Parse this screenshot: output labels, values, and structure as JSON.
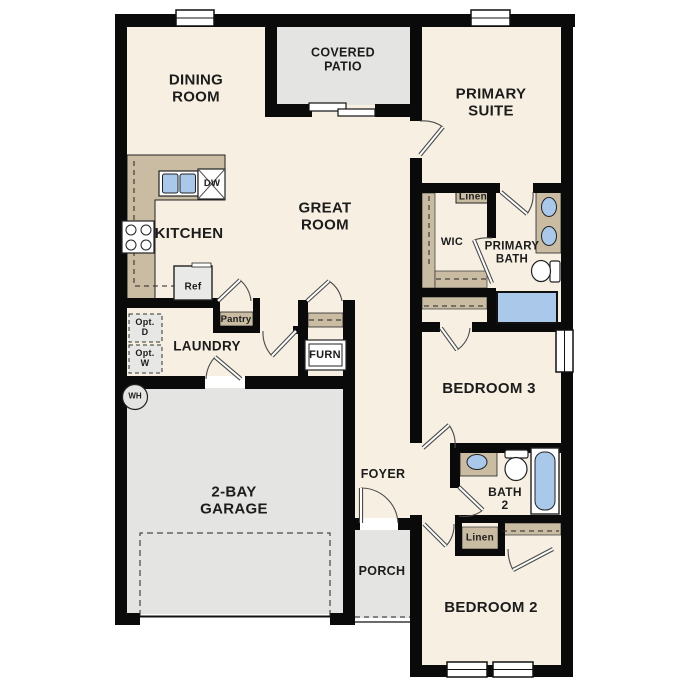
{
  "colors": {
    "wall": "#0a0a0a",
    "floor": "#f7f0e2",
    "outdoor_concrete": "#e4e4e2",
    "cabinetry_tan": "#c9bca2",
    "fixture_blue": "#aac8e9"
  },
  "rooms": {
    "dining_room": "DINING\nROOM",
    "covered_patio": "COVERED\nPATIO",
    "primary_suite": "PRIMARY\nSUITE",
    "kitchen": "KITCHEN",
    "great_room": "GREAT\nROOM",
    "wic": "WIC",
    "primary_bath": "PRIMARY\nBATH",
    "laundry": "LAUNDRY",
    "bedroom_3": "BEDROOM 3",
    "garage": "2-BAY\nGARAGE",
    "foyer": "FOYER",
    "bath_2": "BATH\n2",
    "porch": "PORCH",
    "bedroom_2": "BEDROOM 2"
  },
  "closets": {
    "linen_primary": "Linen",
    "linen_hall": "Linen",
    "pantry": "Pantry",
    "furnace": "FURN"
  },
  "appliances": {
    "dishwasher": "DW",
    "refrigerator": "Ref",
    "water_heater": "WH",
    "optional_dryer": "Opt.\nD",
    "optional_washer": "Opt.\nW"
  }
}
